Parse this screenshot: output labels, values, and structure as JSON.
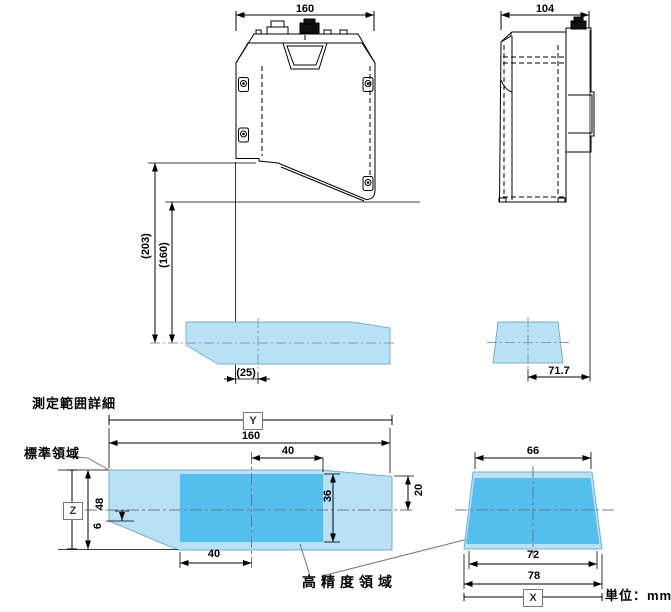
{
  "title": "測定範囲詳細",
  "unit_label": "単位：mm",
  "front_view": {
    "top_width": "160",
    "ref_height_outer": "(203)",
    "ref_height_inner": "(160)",
    "center_offset": "(25)"
  },
  "side_view": {
    "top_width": "104",
    "rear_offset": "71.7"
  },
  "range_front": {
    "axis_y": "Y",
    "axis_z": "Z",
    "total_width": "160",
    "total_height": "48",
    "hp_width_right": "40",
    "hp_width_left": "40",
    "hp_height": "36",
    "right_height_above_center": "20",
    "below_center": "6",
    "standard_area_label": "標準領域",
    "high_precision_label": "高精度領域"
  },
  "range_side": {
    "axis_x": "X",
    "top_width": "66",
    "hp_bottom_width": "72",
    "bottom_width": "78"
  },
  "colors": {
    "standard_area": "#B8E1F6",
    "high_precision_area": "#54BFEF",
    "area_edge": "#79AECB",
    "centerline": "#6B7A85",
    "line": "#000000"
  }
}
